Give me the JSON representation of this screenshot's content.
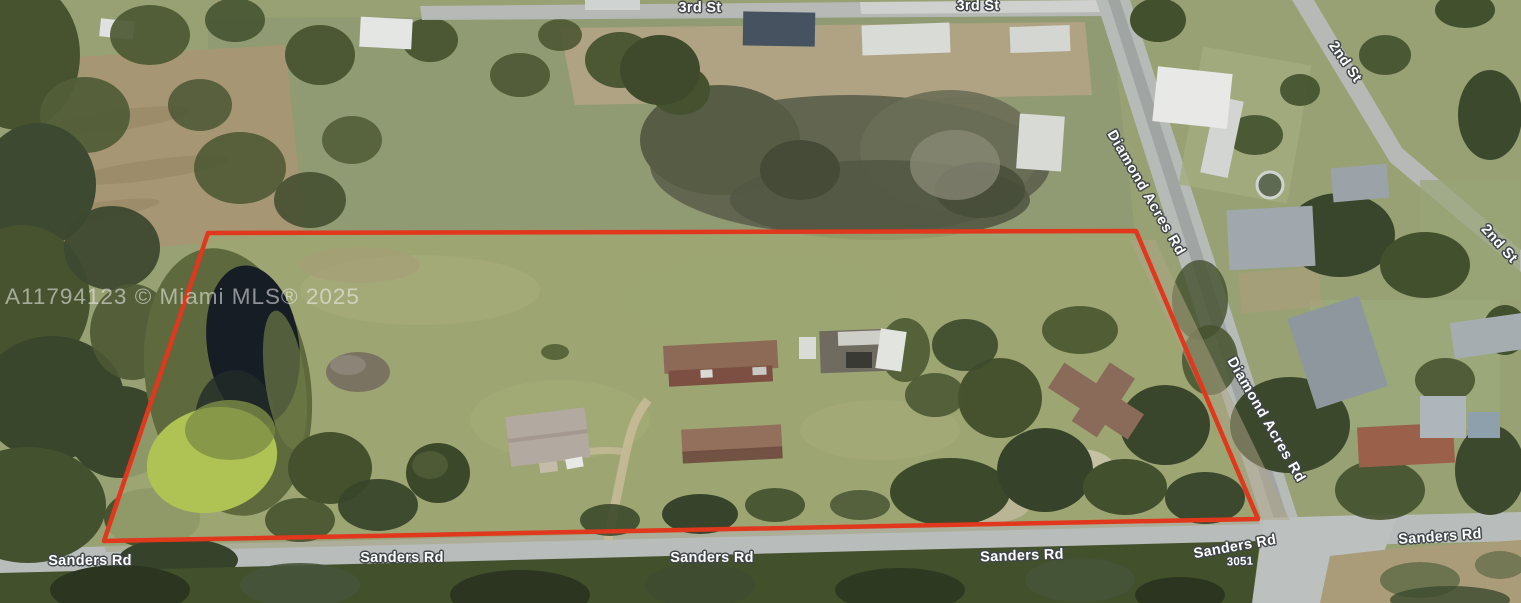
{
  "colors": {
    "parcel_outline": "#e0371d",
    "pasture_green": "#97a173",
    "woods_green": "#42502c",
    "road_gray": "#b7bbb8",
    "pond_water": "#171d25",
    "pond_algae": "#aec353",
    "road_label_text": "#ffffff",
    "road_label_outline": "#41464a",
    "watermark_text": "rgba(242,242,240,0.55)"
  },
  "watermark": {
    "text": "A11794123 © Miami MLS® 2025"
  },
  "road_labels": [
    {
      "name": "third-st-a",
      "text": "3rd St"
    },
    {
      "name": "third-st-b",
      "text": "3rd St"
    },
    {
      "name": "second-st-a",
      "text": "2nd St"
    },
    {
      "name": "second-st-b",
      "text": "2nd St"
    },
    {
      "name": "diamond-acres-rd-a",
      "text": "Diamond Acres Rd"
    },
    {
      "name": "diamond-acres-rd-b",
      "text": "Diamond Acres Rd"
    },
    {
      "name": "sanders-rd-a",
      "text": "Sanders Rd"
    },
    {
      "name": "sanders-rd-b",
      "text": "Sanders Rd"
    },
    {
      "name": "sanders-rd-c",
      "text": "Sanders Rd"
    },
    {
      "name": "sanders-rd-d",
      "text": "Sanders Rd"
    },
    {
      "name": "sanders-rd-e",
      "text": "Sanders Rd"
    },
    {
      "name": "sanders-rd-f",
      "text": "Sanders Rd"
    },
    {
      "name": "house-number",
      "text": "3051"
    }
  ]
}
